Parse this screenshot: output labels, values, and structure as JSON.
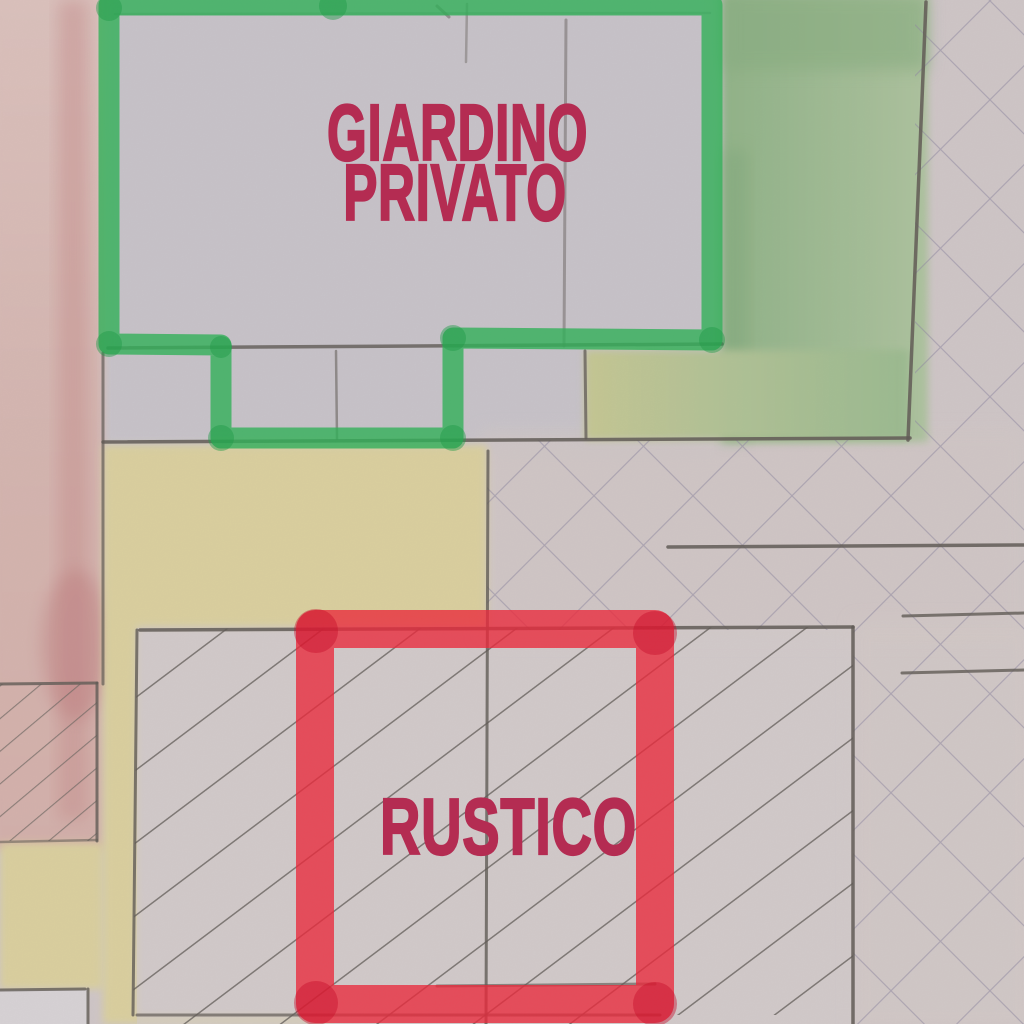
{
  "annotations": {
    "garden": {
      "line1": "GIARDINO",
      "line2": "PRIVATO",
      "outline_color": "#2bb254",
      "text_color": "#b42c52"
    },
    "rustico": {
      "label": "RUSTICO",
      "outline_color": "#ee2135",
      "text_color": "#b42c52"
    }
  },
  "palette": {
    "paper": "#d0c7c8",
    "paper_cool_gray": "#c8c4cb",
    "pink_wash": "#d8b7b2",
    "pink_streak": "#c78e8c",
    "yellow_wash": "#ddd29c",
    "green_wash": "#9cba90",
    "green_wash_light": "#c6c892",
    "pencil_dark": "#5d5751",
    "pencil_crosshatch": "#8d86a0"
  },
  "regions": [
    "giardino privato (green marker outline)",
    "rustico (red marker outline)"
  ]
}
